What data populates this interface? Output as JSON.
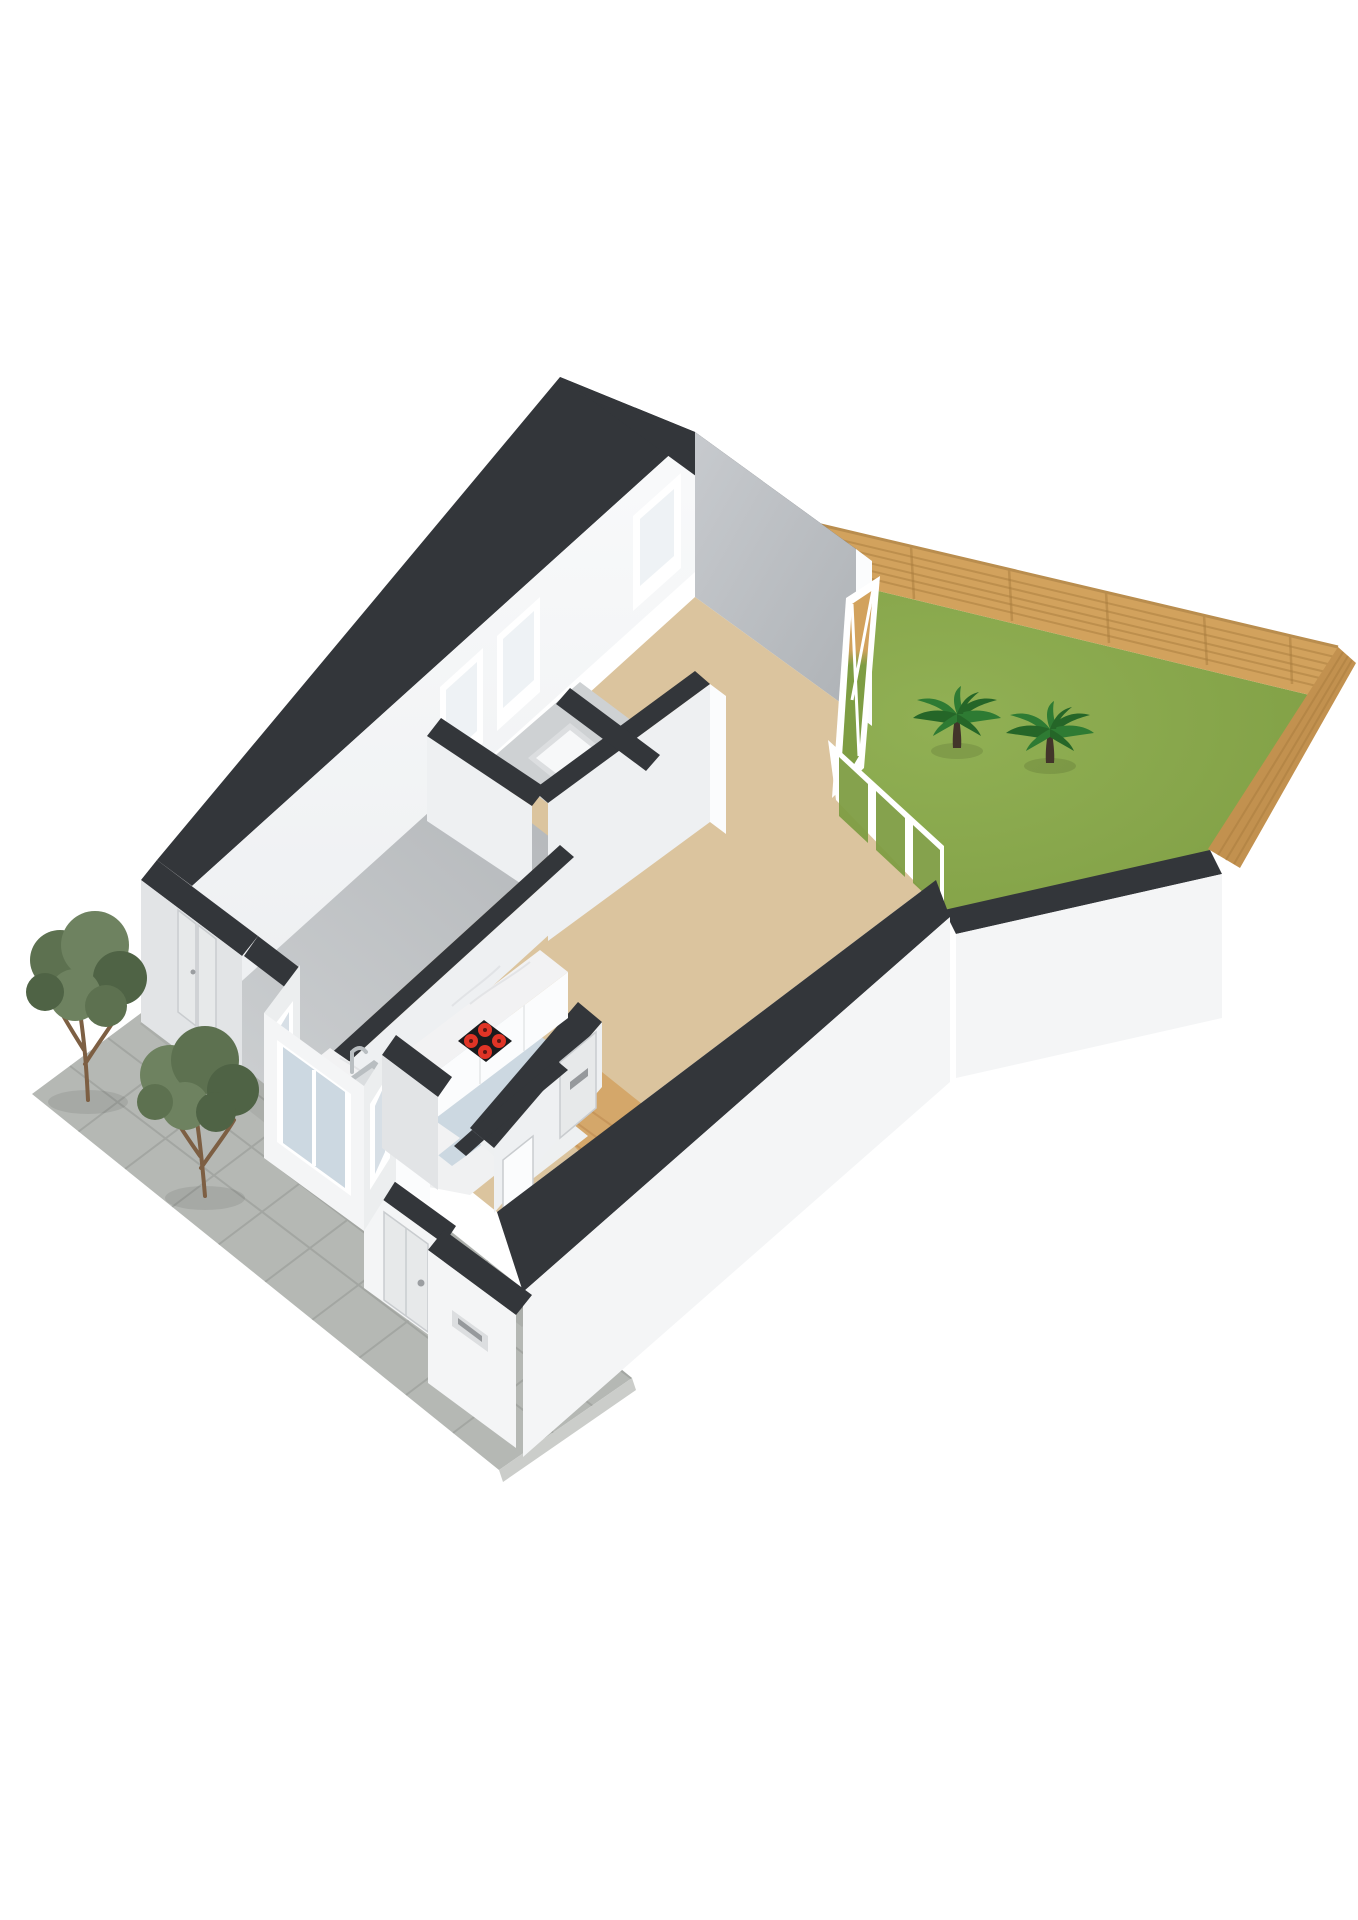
{
  "scene": {
    "kind": "isometric-3d-floorplan-render",
    "background": "#ffffff",
    "rooms": [
      {
        "id": "living-room",
        "floor_color": "#dbc49e"
      },
      {
        "id": "bedroom",
        "floor_color": "#c2c5c8"
      },
      {
        "id": "bathroom",
        "floor_color": "#ced1d3"
      },
      {
        "id": "kitchen",
        "floor_color": "#ccd8e1"
      },
      {
        "id": "entry-hall",
        "floor_color": "#d4a76a"
      },
      {
        "id": "closet",
        "floor_color": "#eef0f1"
      },
      {
        "id": "garden",
        "floor_color": "#7e9d43"
      },
      {
        "id": "patio",
        "floor_color": "#b5b8b4"
      }
    ],
    "counts": {
      "palm_trees": 2,
      "patio_trees": 2,
      "hob_burners": 4,
      "nw_wall_windows": 3,
      "bay_window_panels": 3,
      "garden_door_panels": 3,
      "side_door_panels": 2
    }
  },
  "colors": {
    "bg": "#ffffff",
    "wallCap": "#33363a",
    "wallCapSoft": "#3c3f43",
    "wallWhite": "#f4f5f6",
    "wallWhite2": "#eef0f2",
    "wallExt": "#e2e4e6",
    "wallExt2": "#eceeef",
    "wallLitTop": "#f9fafb",
    "wallLitBot": "#edeff1",
    "wallGrayTop": "#c7cace",
    "wallGrayBot": "#aeb2b6",
    "jambWhite": "#fbfcfd",
    "floorLiving": "#dbc49e",
    "floorBedTop": "#cdd0d2",
    "floorBedBot": "#b4b7ba",
    "floorBath": "#ced1d3",
    "floorKitchen": "#ccd8e1",
    "floorWood": "#d4a76a",
    "floorWoodLine": "#b9854b",
    "floorCloset": "#eef0f1",
    "floorHall": "#f0f1f2",
    "trayWhite": "#f7f8f9",
    "trayEdge": "#dcdee0",
    "grass": "#7e9d43",
    "grassLight": "#91b054",
    "fenceWood": "#d2a25d",
    "fenceWoodDark": "#c2914f",
    "fenceLine": "#a87c3e",
    "fenceRail": "#b98d4e",
    "patio": "#b5b8b4",
    "patioLine": "#9a9d99",
    "patioSide": "#cbcdca",
    "treeFol1": "#5d7150",
    "treeFol2": "#6e8260",
    "treeFol3": "#4f6345",
    "treeTrunk": "#7d5f43",
    "palmGreen": "#2e7b33",
    "palmGreenDk": "#256628",
    "palmTrunk": "#42352a",
    "marble": "#f2f2f3",
    "marbleVein": "#d9dade",
    "cabinet": "#fbfcfd",
    "cabinetSeam": "#e4e6e8",
    "cooktop": "#1a1b1d",
    "burner": "#e03426",
    "burnerCore": "#5c1713",
    "sinkSteel": "#b9bec1",
    "sinkBasin": "#dadddf",
    "sinkDrain": "#8e9396",
    "doorPanel": "#e7e9ea",
    "doorSeam": "#c9cccf",
    "handle": "#9b9ea1",
    "slotDark": "#96999c",
    "glassLight": "#eef2f5",
    "bayGlass": "#d7dfe6",
    "bayGlass2": "#ccd8e1",
    "frameWhite": "#ffffff",
    "shadow": "#000000"
  }
}
